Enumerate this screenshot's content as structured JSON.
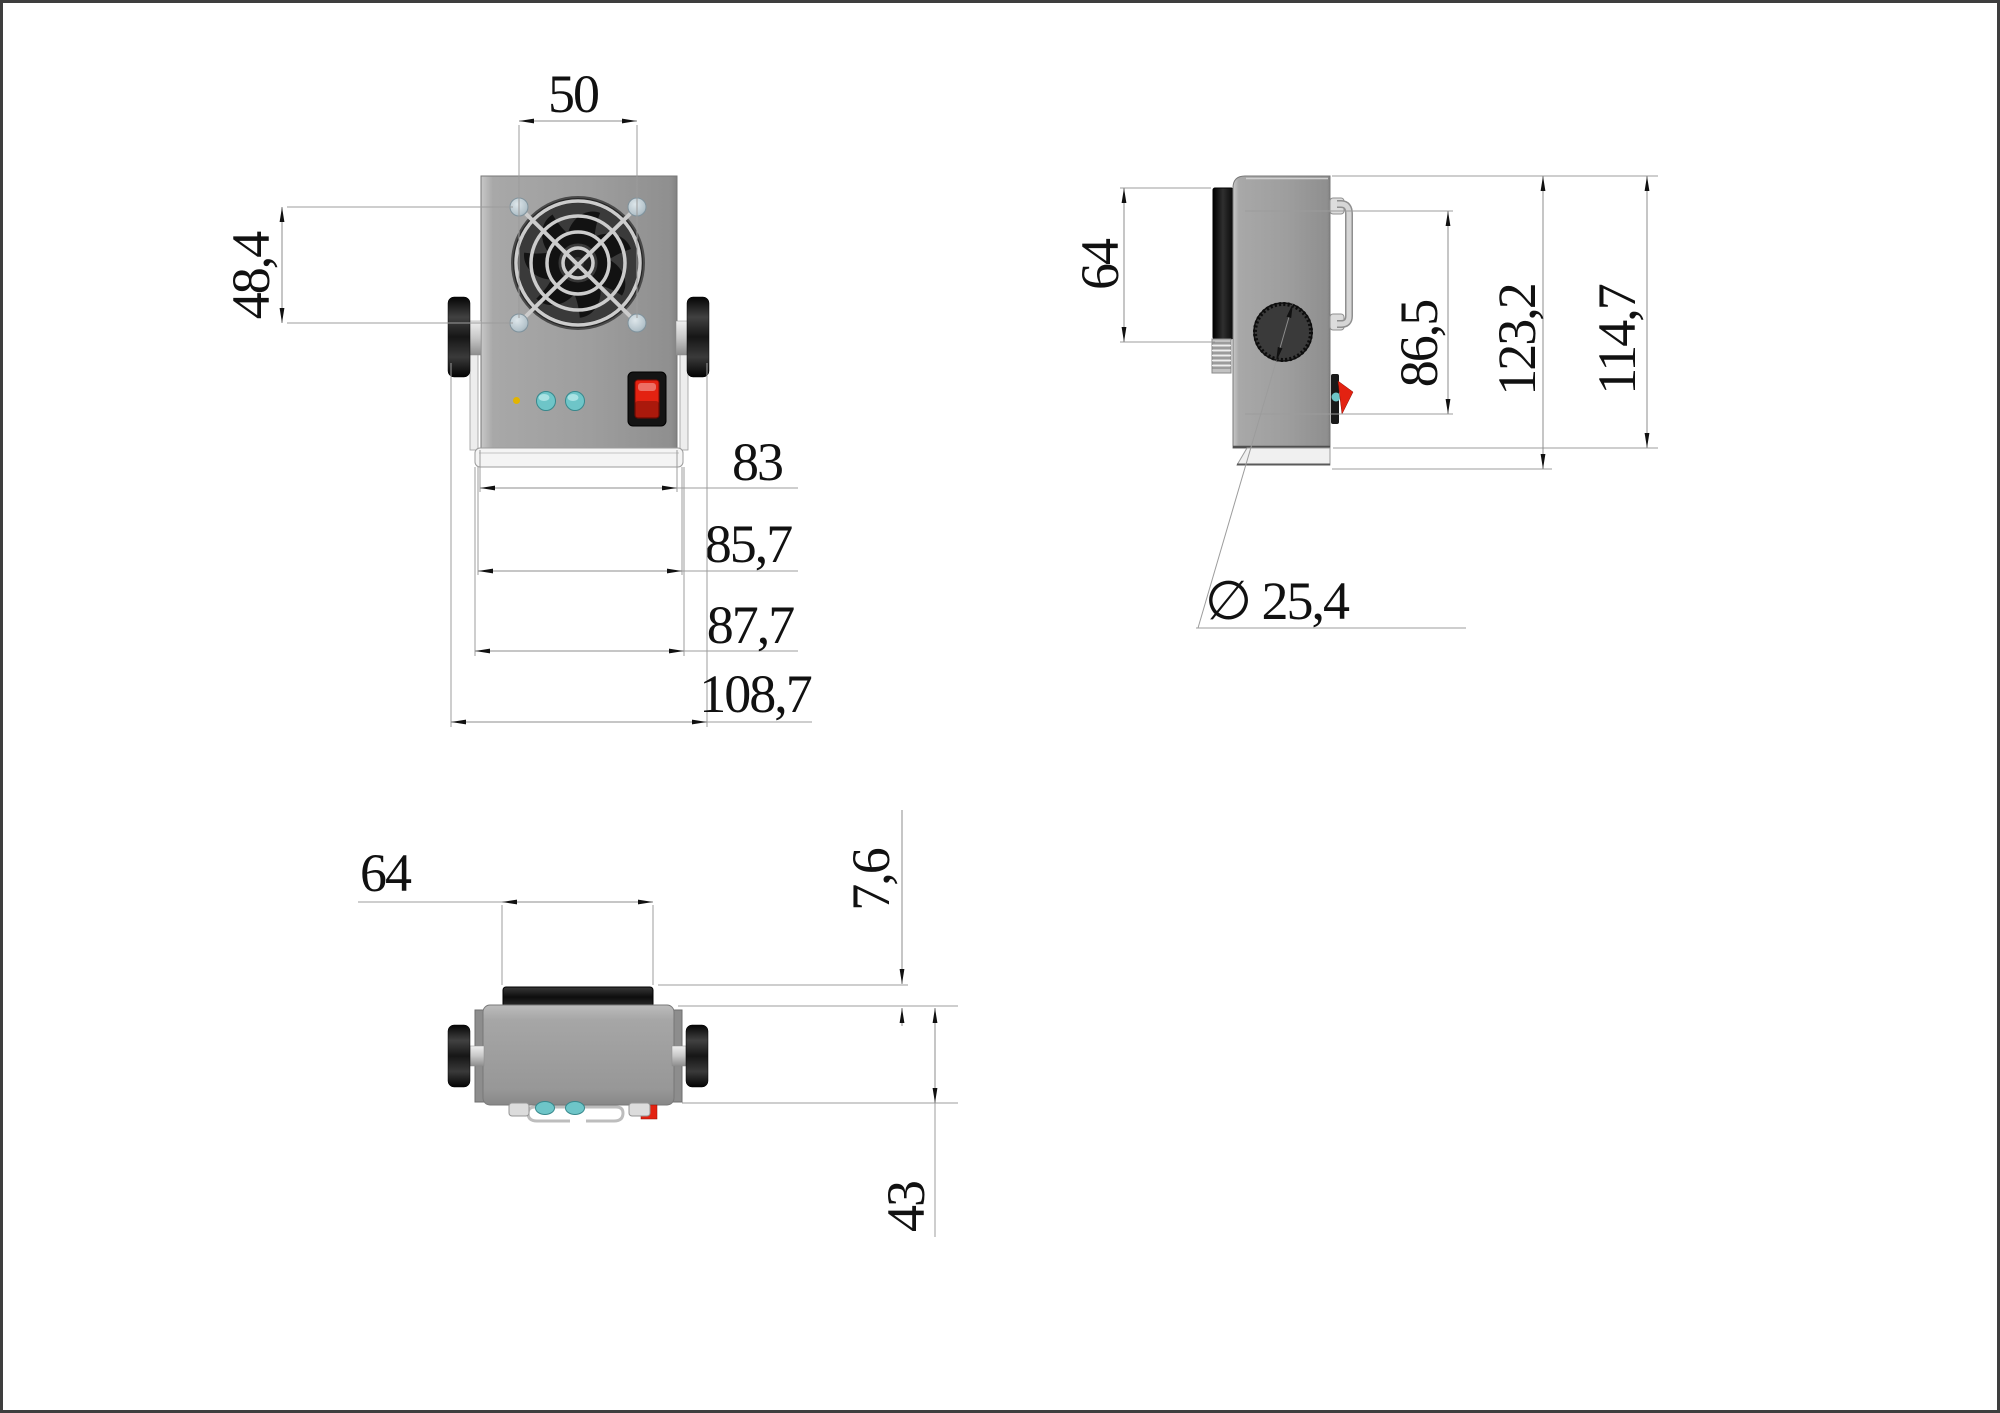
{
  "page": {
    "background": "#ffffff",
    "border_color": "#3e3e3e"
  },
  "views": {
    "front": {
      "dims": {
        "fan_screw_width": "50",
        "fan_screw_height": "48,4",
        "body_width": "83",
        "bracket_inner_width": "85,7",
        "bracket_outer_width": "87,7",
        "overall_width": "108,7"
      }
    },
    "side": {
      "dims": {
        "front_panel_height": "64",
        "handle_to_switch_height": "86,5",
        "overall_height": "123,2",
        "body_height": "114,7",
        "knob_diameter": "∅ 25,4"
      }
    },
    "bottom": {
      "dims": {
        "fan_panel_width": "64",
        "panel_protrusion": "7,6",
        "body_depth": "43"
      }
    }
  },
  "colors": {
    "body_gray": "#a0a0a0",
    "panel_black": "#141414",
    "switch_red": "#e32211",
    "led_teal": "#6ec5c8",
    "led_yellow": "#e2b400",
    "screw_silver": "#b7c4cc",
    "bracket_white": "#f2f2f2",
    "dimension_line": "#8c8c8c",
    "text": "#111111"
  }
}
